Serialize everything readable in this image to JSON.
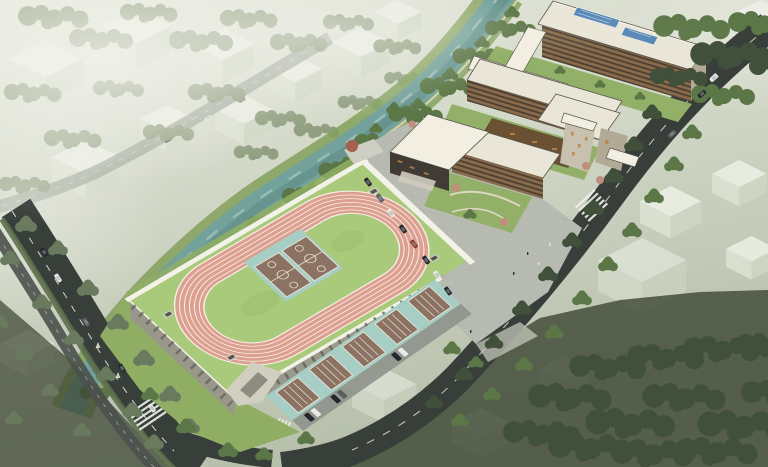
{
  "scene": {
    "description": "Aerial architectural rendering of a riverside school campus: elevated sports deck with oval running track and basketball courts, ground-level courts under a colonnade, paved plaza with parking, angular school buildings with rooftop solar arrays, canal with planted banks, tree-lined boulevards and translucent context massing blocks",
    "features": {
      "running_track_lanes": 6,
      "infield_basketball_courts": 2,
      "ground_level_courts": 5,
      "solar_arrays": 2,
      "context_blocks": 18,
      "river": "canal crossing the site diagonally",
      "roads": [
        "west-boulevard-with-planted-median",
        "east-road",
        "south-access-road",
        "context-road"
      ]
    }
  },
  "palette": {
    "bg_top": "#e6e9dc",
    "bg_bottom": "#b7c0ab",
    "haze": "#f3f4ed",
    "ghost_top": "#eef0e7",
    "ghost_left": "#dde3d3",
    "ghost_right": "#cfd7c5",
    "ctx_tree": "#8a9878",
    "ctx_tree_dark": "#6a7a5e",
    "ctx_road": "#9aa193",
    "rich_tree": "#5c7747",
    "deep_tree": "#41503a",
    "blossom": "#c28d7e",
    "red_tree": "#a85f4e",
    "river": "#73a19b",
    "river_deep": "#5d8b85",
    "river_light": "#b3d0c8",
    "bank": "#82a05c",
    "bank_path": "#e2decb",
    "road": "#383e3a",
    "road_light": "#4b514c",
    "lane": "#f1f2ec",
    "median": "#5d6f4c",
    "plaza": "#b7bbb1",
    "plaza_line": "#a3a79c",
    "walk": "#cdcfc2",
    "apron_grass": "#8fae63",
    "deck_grass": "#a9c97b",
    "grass_mottle": "#9abd6c",
    "track": "#dd9f90",
    "track_line": "#f6efe7",
    "pad_teal": "#a6cec5",
    "court_brown": "#8b7263",
    "court_line": "#ebe6d8",
    "parapet": "#f3f2e8",
    "under_wall": "#98978a",
    "under_shadow": "#5c5c52",
    "struct_light": "#d0cfc0",
    "struct_dark": "#55554c",
    "roof": "#e9e6d8",
    "roof_bright": "#f2efe2",
    "roof_edge": "#57534c",
    "roof_gray": "#cfccbe",
    "facade_wood": "#8a6a48",
    "facade_dark": "#6b5134",
    "window": "#3e3a33",
    "facade_stone": "#b2a996",
    "stone_light": "#c8c1b0",
    "gym_dark": "#403b35",
    "win_orange": "#c08544",
    "solar": "#5586b7",
    "solar_frame": "#e8e8e0",
    "courtyard": "#93b069",
    "court_path": "#ddd7c1",
    "car_dark": "#24272b",
    "car_gray": "#5a5f62",
    "car_white": "#e9eae6",
    "car_red": "#8e3b2f",
    "dark_ground": "#39422f",
    "park_pave": "#8e938c"
  }
}
